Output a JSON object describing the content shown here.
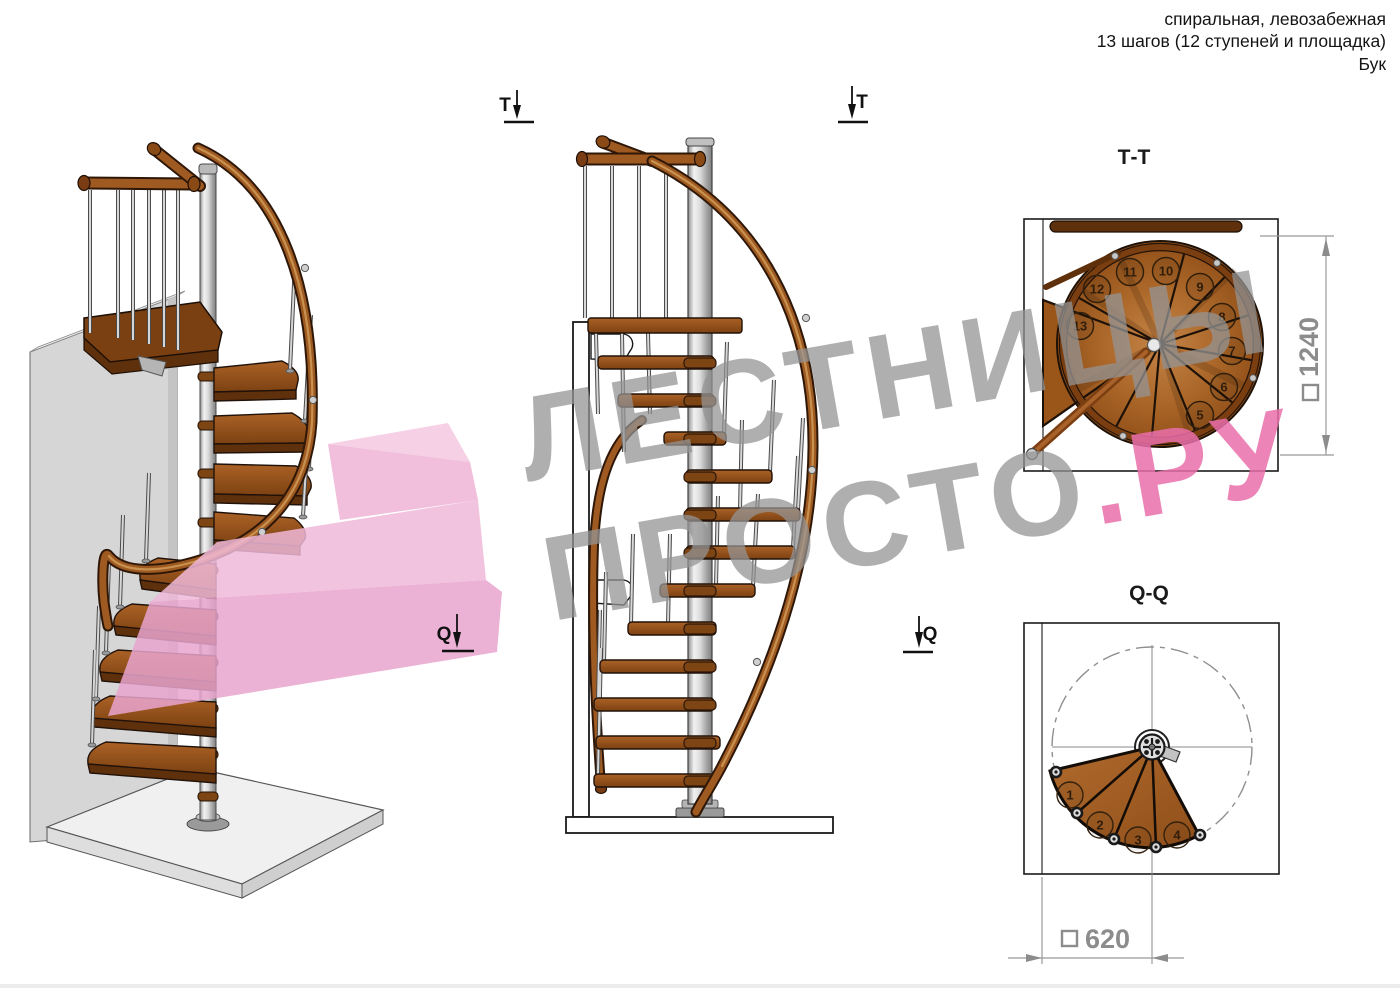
{
  "header": {
    "line1": "спиральная, левозабежная",
    "line2": "13 шагов (12 ступеней и площадка)",
    "line3": "Бук"
  },
  "watermark": {
    "line1": "ЛЕСТНИЦЫ",
    "line2_gray": "ПРОСТО",
    "line2_pink": ".РУ"
  },
  "markers": {
    "t": "Т",
    "q": "Q"
  },
  "plan_tt": {
    "title": "Т-Т",
    "dim_value": "1240",
    "dim_symbol": "□",
    "steps": [
      "5",
      "6",
      "7",
      "8",
      "9",
      "10",
      "11",
      "12",
      "13"
    ]
  },
  "plan_qq": {
    "title": "Q-Q",
    "dim_value": "620",
    "dim_symbol": "□",
    "steps": [
      "1",
      "2",
      "3",
      "4"
    ]
  },
  "colors": {
    "wood": "#a96527",
    "wood_dark": "#7c4112",
    "metal": "#c9c9c9",
    "watermark_gray": "#949494",
    "watermark_pink": "#ec78af",
    "dimension_gray": "#8c8c8c"
  }
}
